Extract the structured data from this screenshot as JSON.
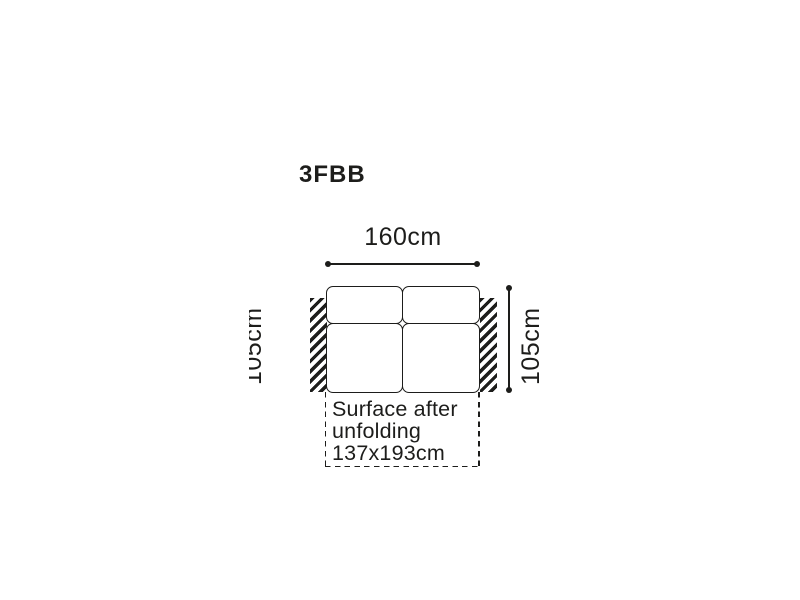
{
  "colors": {
    "ink": "#1d1d1b",
    "background": "#ffffff"
  },
  "diagram": {
    "model_code": "3FBB",
    "sofa": {
      "width_label": "160cm",
      "depth_label_left": "105cm",
      "depth_label_right": "105cm"
    },
    "unfolded_note": {
      "lines": [
        "Surface after",
        "unfolding",
        "137x193cm"
      ]
    }
  }
}
